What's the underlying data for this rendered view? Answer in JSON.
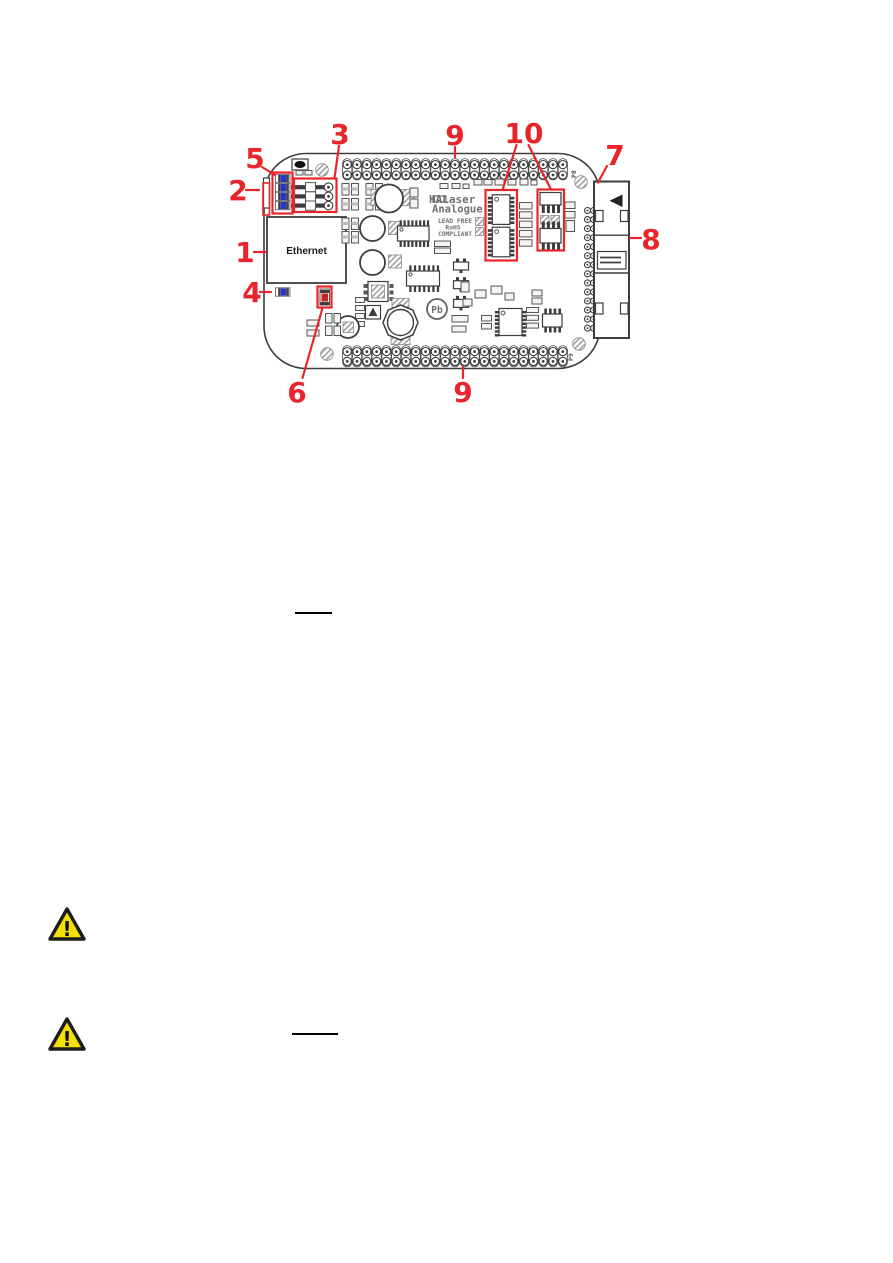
{
  "figure": {
    "board": {
      "ethernet_label": "Ethernet",
      "brand_line1": "HALaser",
      "brand_line2": "Analogue",
      "compliance_line1": "LEAD FREE",
      "compliance_line2": "RoHS",
      "compliance_line3": "COMPLIANT",
      "pb_marking": "Pb",
      "header_top_ref": "P8",
      "header_bottom_ref": "P9",
      "header_pin_columns": 23,
      "header_pin_rows": 2,
      "side_pin_rows": 14,
      "status_led_count": 4
    },
    "callouts": {
      "c1": "1",
      "c2": "2",
      "c3": "3",
      "c4": "4",
      "c5": "5",
      "c6": "6",
      "c7": "7",
      "c8": "8",
      "c9_top": "9",
      "c9_bottom": "9",
      "c10": "10"
    },
    "colors": {
      "callout_red": "#e8252a",
      "led_blue": "#2634d0",
      "component_red": "#cc2020",
      "warning_yellow": "#f5e003",
      "board_line": "#3d3d3d"
    }
  },
  "warning": {
    "glyph": "!"
  }
}
